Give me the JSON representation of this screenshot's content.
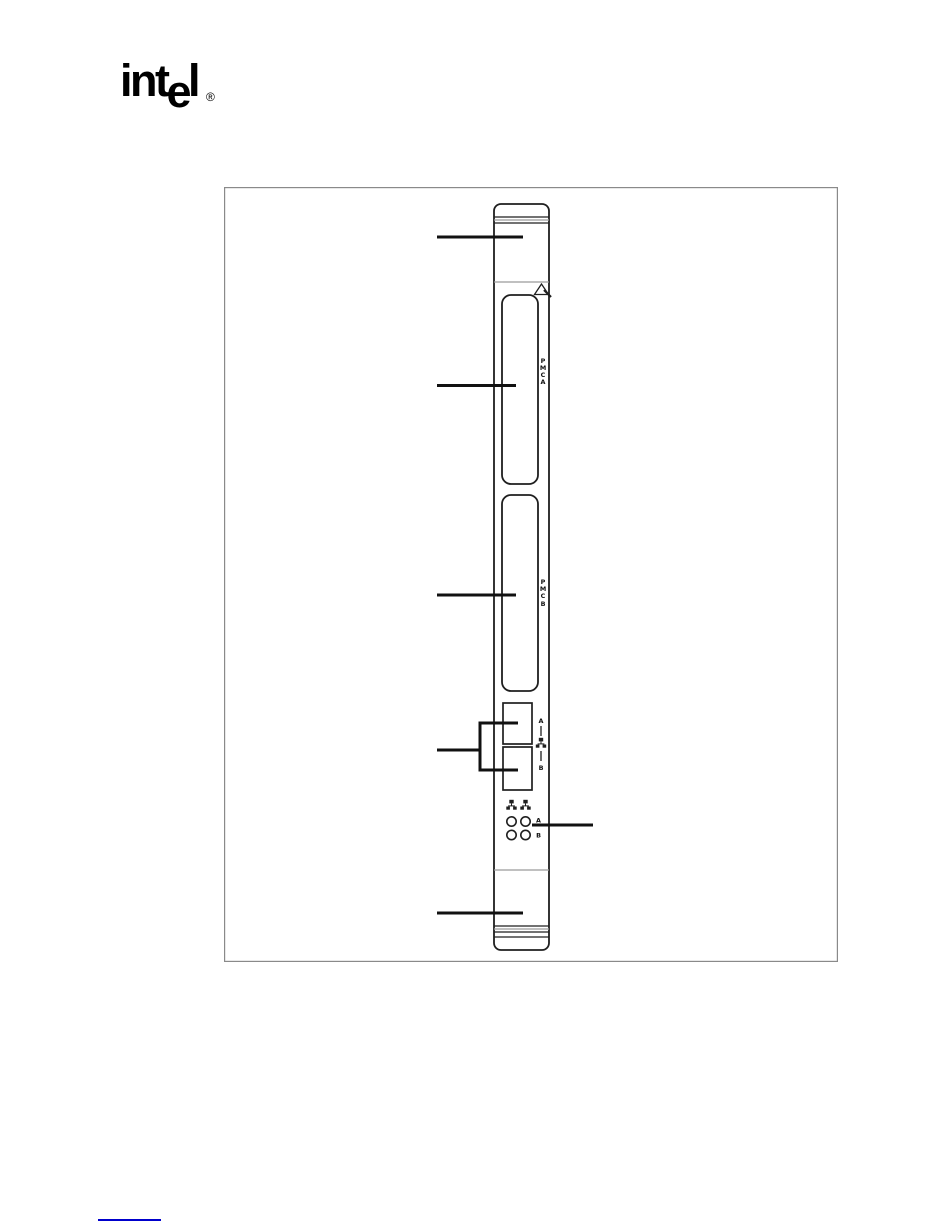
{
  "page": {
    "background": "#ffffff",
    "type": "manual-figure-page"
  },
  "logo": {
    "prefix": "int",
    "dropped": "e",
    "suffix": "l",
    "registered": "®"
  },
  "diagram": {
    "description": "Front panel line drawing of a CompactPCI board",
    "esd_icon": "esd-warning-triangle-icon",
    "pmc_a": {
      "letters": [
        "P",
        "M",
        "C",
        "A"
      ]
    },
    "pmc_b": {
      "letters": [
        "P",
        "M",
        "C",
        "B"
      ]
    },
    "ethernet": {
      "port_a_label": "A",
      "port_b_label": "B",
      "icon": "network-icon"
    },
    "leds": {
      "row_a_label": "A",
      "row_b_label": "B",
      "icon": "network-icon"
    },
    "colors": {
      "outline": "#1f1f1f",
      "frame_border": "#8a8a8a",
      "grip_grey": "#9a9a9a",
      "link_blue": "#0000cc"
    }
  },
  "footer": {
    "link_underline_color": "#0000cc"
  }
}
